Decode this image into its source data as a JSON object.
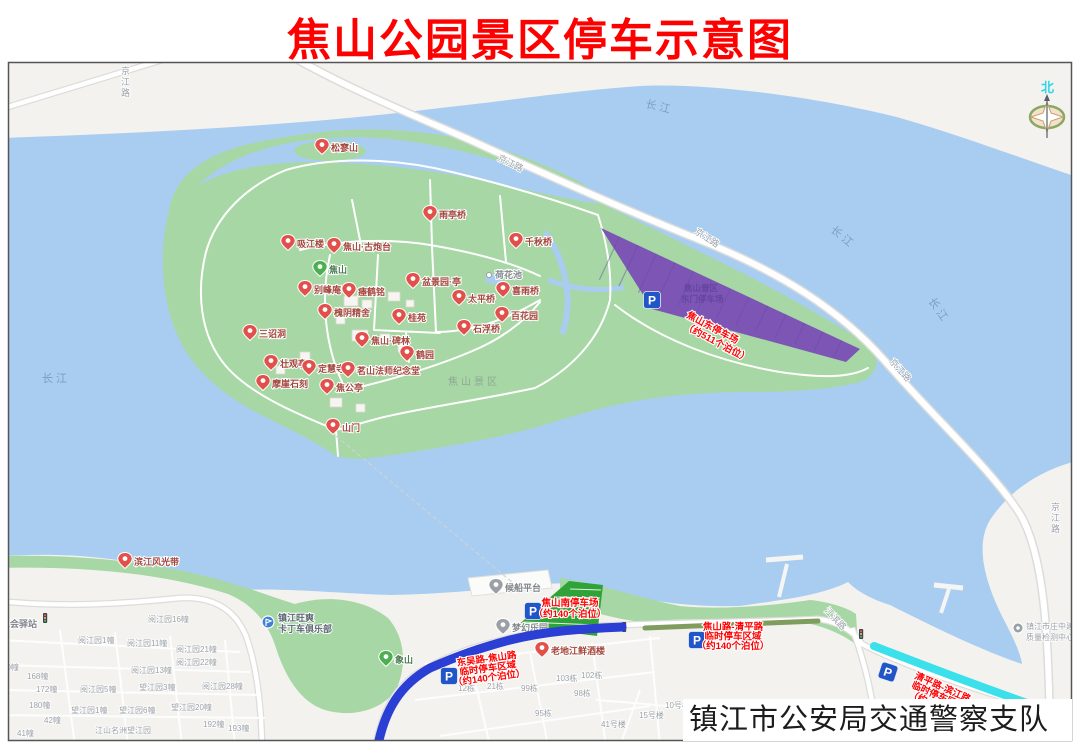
{
  "title": "焦山公园景区停车示意图",
  "footer": "镇江市公安局交通警察支队",
  "compass_north": "北",
  "colors": {
    "title": "#fe0000",
    "water": "#a9cdf1",
    "land": "#f3f2ef",
    "green": "#a6d7a4",
    "east_lot": "#7d56b5",
    "south_lot": "#2fa337",
    "band_blue": "#2b3fd4",
    "band_olive": "#7f9d5c",
    "band_cyan": "#3ae0ea",
    "p_icon": "#2156c8",
    "parking_label": "#ff0000"
  },
  "parking_lots": [
    {
      "id": "east",
      "name": "焦山东停车场",
      "capacity": "（约511个泊位）"
    },
    {
      "id": "south",
      "name": "焦山南停车场",
      "capacity": "（约140个泊位）"
    },
    {
      "id": "dongwu",
      "line1": "东吴路-焦山路",
      "line2": "临时停车区域",
      "line3": "（约140个泊位）"
    },
    {
      "id": "qingping1",
      "line1": "焦山路-清平路",
      "line2": "临时停车区域",
      "line3": "（约140个泊位）"
    },
    {
      "id": "qingping2",
      "line1": "清平路-滨江路",
      "line2": "临时停车区域",
      "line3": "（约140个泊位）"
    }
  ],
  "underlying_lot_label": {
    "line1": "焦山景区",
    "line2": "东门停车场"
  },
  "scenic_label": {
    "name": "焦山景区",
    "x": 448,
    "y": 385
  },
  "road_labels": {
    "jingjiang": "京江路",
    "yangtze": "长江",
    "jiangbin": "江滨路"
  },
  "road_label_instances": [
    {
      "key": "jingjiang",
      "x": 121,
      "y": 74,
      "v": true
    },
    {
      "key": "jingjiang",
      "x": 497,
      "y": 160,
      "r": 26
    },
    {
      "key": "jingjiang",
      "x": 694,
      "y": 233,
      "r": 33
    },
    {
      "key": "jingjiang",
      "x": 889,
      "y": 362,
      "r": 48
    },
    {
      "key": "jingjiang",
      "x": 1051,
      "y": 510,
      "v": true
    },
    {
      "key": "yangtze",
      "x": 645,
      "y": 107,
      "r": 14,
      "w": true
    },
    {
      "key": "yangtze",
      "x": 830,
      "y": 231,
      "r": 40,
      "w": true
    },
    {
      "key": "yangtze",
      "x": 928,
      "y": 301,
      "r": 55,
      "w": true
    },
    {
      "key": "yangtze",
      "x": 42,
      "y": 382,
      "r": 0,
      "w": true
    },
    {
      "key": "jiangbin",
      "x": 824,
      "y": 611,
      "r": 47
    }
  ],
  "pois": {
    "red": [
      {
        "name": "松寥山",
        "x": 322,
        "y": 148
      },
      {
        "name": "吸江楼",
        "x": 288,
        "y": 244
      },
      {
        "name": "焦山·古炮台",
        "x": 334,
        "y": 247
      },
      {
        "name": "雨亭桥",
        "x": 430,
        "y": 215
      },
      {
        "name": "千秋桥",
        "x": 516,
        "y": 242
      },
      {
        "name": "别峰庵",
        "x": 305,
        "y": 290
      },
      {
        "name": "瘗鹤铭",
        "x": 349,
        "y": 292
      },
      {
        "name": "盆景园·亭",
        "x": 413,
        "y": 282
      },
      {
        "name": "太平桥",
        "x": 459,
        "y": 299
      },
      {
        "name": "喜雨桥",
        "x": 503,
        "y": 291
      },
      {
        "name": "百花园",
        "x": 502,
        "y": 316
      },
      {
        "name": "石浮桥",
        "x": 464,
        "y": 329
      },
      {
        "name": "桂苑",
        "x": 399,
        "y": 318
      },
      {
        "name": "槐阴精舍",
        "x": 325,
        "y": 313
      },
      {
        "name": "焦山·碑林",
        "x": 362,
        "y": 341
      },
      {
        "name": "鹤园",
        "x": 407,
        "y": 355
      },
      {
        "name": "三诏洞",
        "x": 250,
        "y": 334
      },
      {
        "name": "壮观亭",
        "x": 271,
        "y": 364
      },
      {
        "name": "定慧寺",
        "x": 309,
        "y": 369
      },
      {
        "name": "茗山法师纪念堂",
        "x": 348,
        "y": 371
      },
      {
        "name": "摩崖石刻",
        "x": 263,
        "y": 384
      },
      {
        "name": "焦公亭",
        "x": 327,
        "y": 388
      },
      {
        "name": "山门",
        "x": 333,
        "y": 428
      },
      {
        "name": "滨江风光带",
        "x": 125,
        "y": 562
      },
      {
        "name": "老地江鲜酒楼",
        "x": 542,
        "y": 651
      }
    ],
    "grey": [
      {
        "name": "候船平台",
        "x": 496,
        "y": 588
      },
      {
        "name": "梦幻乐园",
        "x": 503,
        "y": 628
      },
      {
        "name": "工会驿站",
        "x": -8,
        "y": 624
      }
    ],
    "green": [
      {
        "name": "焦山",
        "x": 320,
        "y": 270
      },
      {
        "name": "象山",
        "x": 386,
        "y": 660
      }
    ],
    "dot": [
      {
        "name": "荷花池",
        "x": 489,
        "y": 275
      }
    ],
    "club": {
      "line1": "镇江旺爽",
      "line2": "卡丁车俱乐部",
      "x": 268,
      "y": 622
    },
    "inspection": {
      "line1": "镇江市庄中建设",
      "line2": "质量检测中心",
      "x": 1018,
      "y": 628
    },
    "estate": {
      "name": "江山名洲望江园",
      "x": 95,
      "y": 733
    }
  },
  "buildings": [
    [
      "阅江园16幢",
      148,
      622
    ],
    [
      "阅江园1幢",
      78,
      643
    ],
    [
      "阅江园11幢",
      127,
      646
    ],
    [
      "阅江园21幢",
      176,
      652
    ],
    [
      "阅江园22幢",
      176,
      665
    ],
    [
      "阅江园13幢",
      131,
      673
    ],
    [
      "阅江园5幢",
      80,
      692
    ],
    [
      "望江园3幢",
      139,
      690
    ],
    [
      "阅江园28幢",
      202,
      689
    ],
    [
      "望江园1幢",
      71,
      713
    ],
    [
      "望江园6幢",
      119,
      713
    ],
    [
      "望江园20幢",
      171,
      710
    ],
    [
      "60幢",
      2,
      670
    ],
    [
      "168幢",
      27,
      679
    ],
    [
      "172幢",
      36,
      692
    ],
    [
      "180幢",
      29,
      708
    ],
    [
      "42幢",
      44,
      723
    ],
    [
      "41幢",
      17,
      736
    ],
    [
      "192幢",
      203,
      727
    ],
    [
      "193幢",
      228,
      731
    ],
    [
      "苑",
      2,
      702
    ],
    [
      "103栋",
      556,
      681
    ],
    [
      "102栋",
      581,
      678
    ],
    [
      "99栋",
      521,
      691
    ],
    [
      "98栋",
      574,
      696
    ],
    [
      "12栋",
      458,
      691
    ],
    [
      "21栋",
      487,
      689
    ],
    [
      "95栋",
      535,
      716
    ],
    [
      "41号楼",
      601,
      727
    ],
    [
      "15号楼",
      639,
      718
    ],
    [
      "10号楼",
      665,
      708
    ],
    [
      "9号楼",
      692,
      712
    ],
    [
      "8号楼",
      715,
      718
    ],
    [
      "中南 昀江阁",
      749,
      715
    ]
  ]
}
